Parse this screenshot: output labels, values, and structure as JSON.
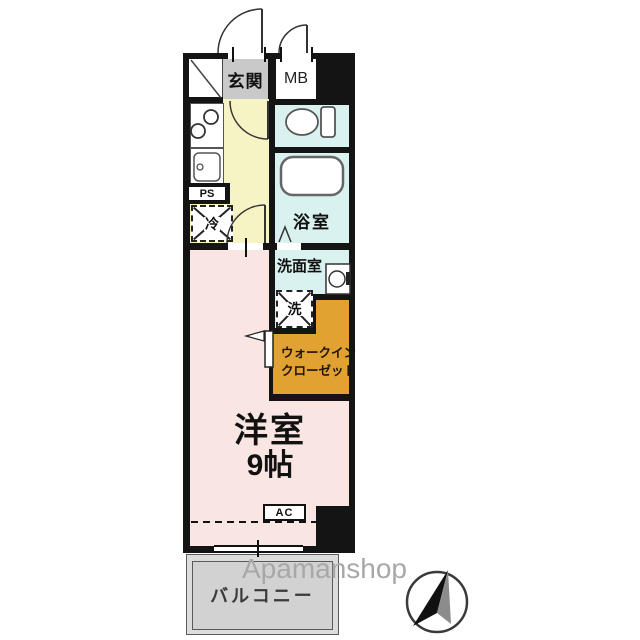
{
  "plan": {
    "title_watermark": "Apamanshop",
    "rooms": {
      "genkan": "玄関",
      "mb": "MB",
      "ps": "PS",
      "fridge": "冷",
      "bathroom": "浴室",
      "washroom": "洗面室",
      "washer": "洗",
      "closet_line1": "ウォークイン",
      "closet_line2": "クローゼット",
      "main_room_line1": "洋室",
      "main_room_line2": "9帖",
      "ac": "AC",
      "balcony": "バルコニー"
    },
    "icons": {
      "north_arrow": "compass-north-arrow",
      "toilet": "toilet-icon",
      "bathtub": "bathtub-icon",
      "stove": "two-burner-stove-icon",
      "sink": "kitchen-sink-icon",
      "basin": "washbasin-icon",
      "door_arcs": "door-swing-arc"
    },
    "colors": {
      "wall": "#141414",
      "genkan_floor": "#c9c9c9",
      "kitchen_floor": "#f6f3c5",
      "wet_floor": "#d9f1ef",
      "closet_floor": "#e2a231",
      "room_floor": "#f9e6e3",
      "balcony_floor": "#dcdcdc",
      "watermark_color": "#a8a8a8"
    }
  }
}
